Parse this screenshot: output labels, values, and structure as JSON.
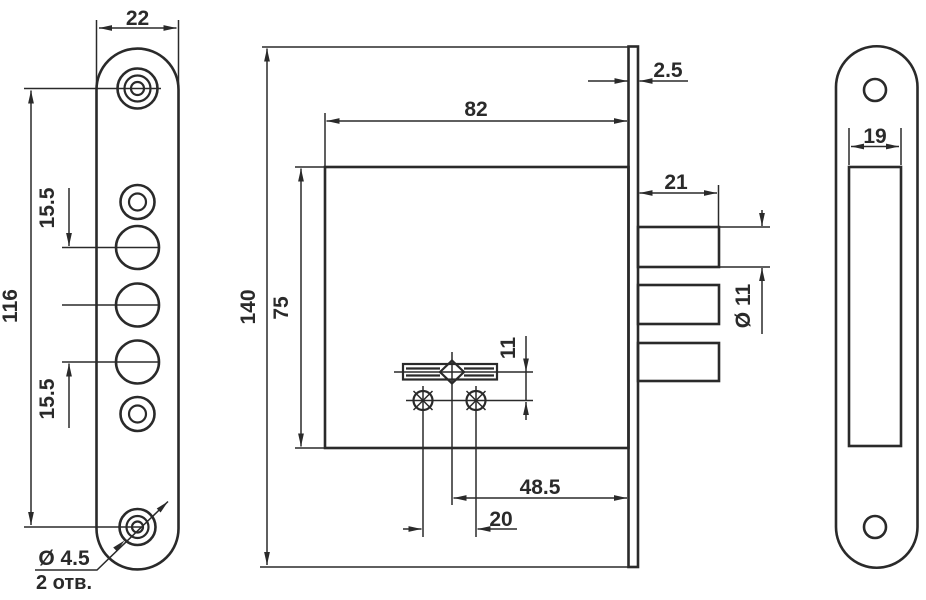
{
  "document": {
    "type": "technical drawing",
    "subject": "mortise lock — three-view dimensional drawing",
    "ink_color": "#2a2a2a",
    "background_color": "#ffffff"
  },
  "views": {
    "faceplate": {
      "width": "22",
      "hole_span_height": "116",
      "bolt_hole_spacing_upper": "15.5",
      "bolt_hole_spacing_lower": "15.5",
      "screw_hole_diameter": "Ø 4.5",
      "screw_hole_count": "2 отв."
    },
    "lock_body": {
      "faceplate_height": "140",
      "case_height": "75",
      "case_width": "82",
      "faceplate_thickness": "2.5",
      "bolt_throw": "21",
      "bolt_diameter": "Ø 11",
      "cylinder_axis_offset": "11",
      "backset": "48.5",
      "fixing_screw_spacing": "20"
    },
    "strike_plate": {
      "cutout_width": "19"
    }
  }
}
